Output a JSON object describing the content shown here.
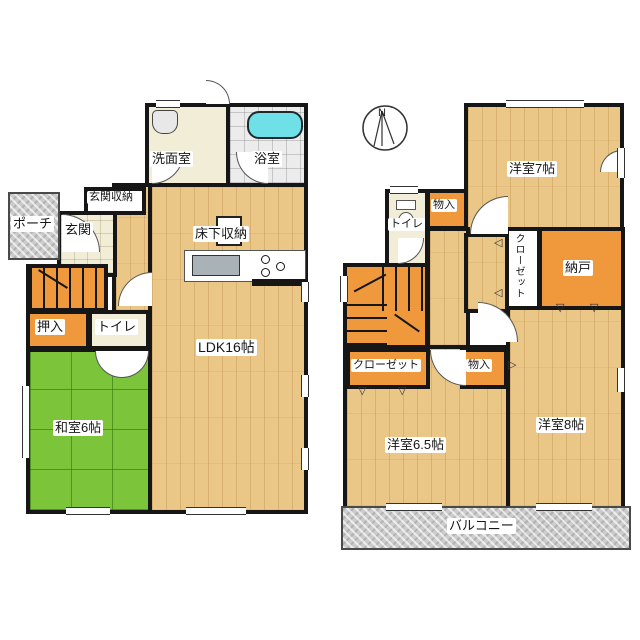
{
  "page": {
    "title": "2-story house floor plan"
  },
  "colors": {
    "wall": "#161616",
    "wood_floor": "#eac787",
    "tatami_green": "#7cc53a",
    "storage_orange": "#f0993c",
    "cream_floor": "#f2edd6",
    "bath_gray": "#ececec",
    "porch_gray": "#cccccc",
    "bathtub_cyan": "#6fdfe8"
  },
  "compass": {
    "label": "N"
  },
  "icons": {
    "triangle_down": "▽",
    "triangle_left": "◁",
    "triangle_right": "▷"
  },
  "floor1": {
    "washroom_label": "洗面室",
    "bathroom_label": "浴室",
    "entrance_storage_label": "玄関収納",
    "porch_label": "ポーチ",
    "entrance_label": "玄関",
    "underfloor_storage_label": "床下収納",
    "closet_label": "押入",
    "toilet_label": "トイレ",
    "tatami_room_label": "和室6帖",
    "ldk_label": "LDK16帖"
  },
  "floor2": {
    "bedroom7_label": "洋室7帖",
    "toilet_label": "トイレ",
    "storage_upper_label": "物入",
    "closet_vertical_label": "クローゼット",
    "storeroom_label": "納戸",
    "closet_label": "クローゼット",
    "storage_lower_label": "物入",
    "bedroom65_label": "洋室6.5帖",
    "bedroom8_label": "洋室8帖",
    "balcony_label": "バルコニー"
  }
}
